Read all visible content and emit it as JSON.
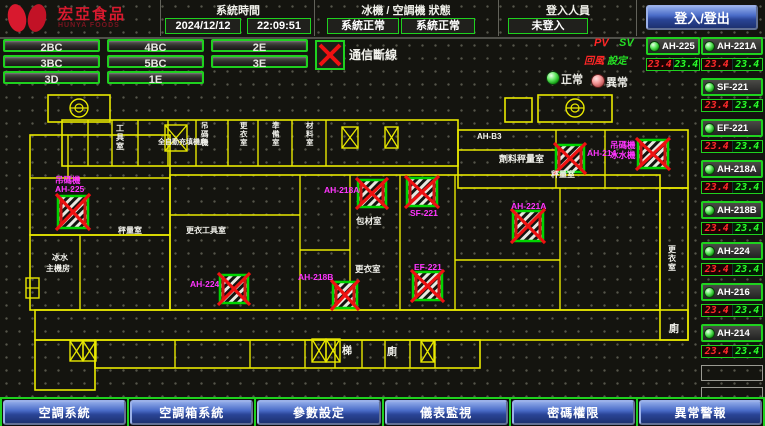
{
  "header": {
    "brand": "宏亞食品",
    "brand_en": "HUNYA FOODS",
    "system_time_label": "系統時間",
    "date": "2024/12/12",
    "time": "22:09:51",
    "status_label": "冰機 / 空調機 狀態",
    "chiller_status": "系統正常",
    "ahu_status": "系統正常",
    "login_label": "登入人員",
    "login_status": "未登入",
    "login_button": "登入/登出"
  },
  "floor_buttons": [
    "2BC",
    "4BC",
    "2E",
    "3BC",
    "5BC",
    "3E",
    "3D",
    "1E"
  ],
  "legend": {
    "comm_fail_label": "通信斷線",
    "normal_label": "正常",
    "abnormal_label": "異常",
    "pv": "PV",
    "sv": "SV",
    "pv_sub": "回風",
    "sv_sub": "設定"
  },
  "ahu_panel": {
    "left_column": [
      {
        "name": "AH-225",
        "pv": "23.4",
        "sv": "23.4"
      }
    ],
    "right_column": [
      {
        "name": "AH-221A",
        "pv": "23.4",
        "sv": "23.4"
      },
      {
        "name": "SF-221",
        "pv": "23.4",
        "sv": "23.4"
      },
      {
        "name": "EF-221",
        "pv": "23.4",
        "sv": "23.4"
      },
      {
        "name": "AH-218A",
        "pv": "23.4",
        "sv": "23.4"
      },
      {
        "name": "AH-218B",
        "pv": "23.4",
        "sv": "23.4"
      },
      {
        "name": "AH-224",
        "pv": "23.4",
        "sv": "23.4"
      },
      {
        "name": "AH-216",
        "pv": "23.4",
        "sv": "23.4"
      },
      {
        "name": "AH-214",
        "pv": "23.4",
        "sv": "23.4"
      }
    ],
    "empty_slots": 2
  },
  "bottom_nav": [
    "空調系統",
    "空調箱系統",
    "參數設定",
    "儀表監視",
    "密碼權限",
    "異常警報"
  ],
  "colors": {
    "wall": "#e8e800",
    "device_border": "#00d400",
    "cross": "#ee1111",
    "magenta": "#ff35ff",
    "white": "#f2f2ec"
  },
  "plan": {
    "rects": [
      [
        62,
        120,
        396,
        46
      ],
      [
        458,
        130,
        230,
        58
      ],
      [
        48,
        95,
        62,
        27
      ],
      [
        538,
        95,
        74,
        27
      ],
      [
        505,
        98,
        27,
        24
      ],
      [
        30,
        135,
        140,
        100
      ],
      [
        30,
        235,
        140,
        75
      ],
      [
        170,
        175,
        490,
        135
      ],
      [
        35,
        310,
        653,
        30
      ],
      [
        95,
        340,
        385,
        28
      ],
      [
        35,
        340,
        60,
        50
      ],
      [
        660,
        188,
        28,
        152
      ]
    ],
    "lines": [
      [
        88,
        120,
        88,
        166
      ],
      [
        112,
        120,
        112,
        166
      ],
      [
        138,
        120,
        138,
        166
      ],
      [
        168,
        120,
        168,
        166
      ],
      [
        196,
        120,
        196,
        166
      ],
      [
        228,
        120,
        228,
        166
      ],
      [
        258,
        120,
        258,
        166
      ],
      [
        292,
        120,
        292,
        166
      ],
      [
        326,
        120,
        326,
        166
      ],
      [
        458,
        150,
        556,
        150
      ],
      [
        556,
        130,
        556,
        188
      ],
      [
        605,
        130,
        605,
        188
      ],
      [
        30,
        178,
        170,
        178
      ],
      [
        68,
        135,
        68,
        178
      ],
      [
        80,
        235,
        80,
        310
      ],
      [
        300,
        175,
        300,
        310
      ],
      [
        350,
        175,
        350,
        310
      ],
      [
        400,
        175,
        400,
        310
      ],
      [
        455,
        175,
        455,
        310
      ],
      [
        560,
        188,
        560,
        310
      ],
      [
        170,
        215,
        300,
        215
      ],
      [
        300,
        250,
        350,
        250
      ],
      [
        455,
        260,
        560,
        260
      ],
      [
        175,
        340,
        175,
        368
      ],
      [
        250,
        340,
        250,
        368
      ],
      [
        305,
        340,
        305,
        368
      ],
      [
        335,
        340,
        335,
        368
      ],
      [
        362,
        340,
        362,
        368
      ],
      [
        385,
        340,
        385,
        368
      ],
      [
        410,
        340,
        410,
        368
      ],
      [
        435,
        340,
        435,
        368
      ]
    ],
    "xboxes": [
      [
        165,
        125,
        22,
        26
      ],
      [
        342,
        127,
        16,
        21
      ],
      [
        385,
        127,
        13,
        21
      ],
      [
        70,
        341,
        13,
        20
      ],
      [
        83,
        341,
        13,
        20
      ],
      [
        312,
        339,
        14,
        23
      ],
      [
        326,
        339,
        14,
        23
      ],
      [
        421,
        341,
        13,
        21
      ]
    ],
    "stairs": [
      [
        79,
        108
      ],
      [
        575,
        108
      ]
    ],
    "mini": [
      26,
      278,
      13,
      20
    ],
    "devices": [
      {
        "id": "AH-225",
        "x": 58,
        "y": 196,
        "w": 30,
        "h": 32
      },
      {
        "id": "AH-224",
        "x": 220,
        "y": 275,
        "w": 28,
        "h": 28
      },
      {
        "id": "AH-218A",
        "x": 358,
        "y": 180,
        "w": 28,
        "h": 27
      },
      {
        "id": "SF-221",
        "x": 407,
        "y": 178,
        "w": 30,
        "h": 28
      },
      {
        "id": "EF-221",
        "x": 413,
        "y": 272,
        "w": 29,
        "h": 28
      },
      {
        "id": "AH-218B",
        "x": 333,
        "y": 282,
        "w": 24,
        "h": 26
      },
      {
        "id": "AH-221A",
        "x": 513,
        "y": 211,
        "w": 30,
        "h": 30
      },
      {
        "id": "AH-214",
        "x": 556,
        "y": 145,
        "w": 28,
        "h": 27
      },
      {
        "id": "冰水機",
        "x": 638,
        "y": 140,
        "w": 30,
        "h": 28
      }
    ],
    "labels_magenta": [
      {
        "text": "吊碼機",
        "x": 55,
        "y": 183
      },
      {
        "text": "AH-225",
        "x": 55,
        "y": 192
      },
      {
        "text": "AH-224",
        "x": 190,
        "y": 287
      },
      {
        "text": "AH-218A",
        "x": 324,
        "y": 193
      },
      {
        "text": "SF-221",
        "x": 410,
        "y": 216
      },
      {
        "text": "EF-221",
        "x": 414,
        "y": 270
      },
      {
        "text": "AH-218B",
        "x": 298,
        "y": 280
      },
      {
        "text": "AH-221A",
        "x": 511,
        "y": 209
      },
      {
        "text": "AH-214",
        "x": 587,
        "y": 156
      },
      {
        "text": "吊碼機",
        "x": 610,
        "y": 148
      },
      {
        "text": "冰水機",
        "x": 610,
        "y": 158
      }
    ],
    "labels_white": [
      {
        "text": "工具室",
        "x": 116,
        "y": 131,
        "vert": true,
        "size": 8
      },
      {
        "text": "全自動充填機房",
        "x": 158,
        "y": 144,
        "vert": false,
        "size": 7
      },
      {
        "text": "吊碼機",
        "x": 201,
        "y": 128,
        "vert": true,
        "size": 7.5
      },
      {
        "text": "更衣室",
        "x": 240,
        "y": 128,
        "vert": true,
        "size": 7.5
      },
      {
        "text": "準備室",
        "x": 272,
        "y": 128,
        "vert": true,
        "size": 7.5
      },
      {
        "text": "材料室",
        "x": 306,
        "y": 128,
        "vert": true,
        "size": 7.5
      },
      {
        "text": "AH-B3",
        "x": 477,
        "y": 139,
        "vert": false,
        "size": 8
      },
      {
        "text": "劑料秤量室",
        "x": 499,
        "y": 162,
        "vert": false,
        "size": 9
      },
      {
        "text": "秤量室",
        "x": 551,
        "y": 177,
        "vert": false,
        "size": 8
      },
      {
        "text": "包材室",
        "x": 356,
        "y": 224,
        "vert": false,
        "size": 8.5
      },
      {
        "text": "更衣室",
        "x": 355,
        "y": 272,
        "vert": false,
        "size": 8.5
      },
      {
        "text": "冰水",
        "x": 52,
        "y": 260,
        "vert": false,
        "size": 8
      },
      {
        "text": "主機房",
        "x": 46,
        "y": 271,
        "vert": false,
        "size": 8
      },
      {
        "text": "秤量室",
        "x": 118,
        "y": 233,
        "vert": false,
        "size": 8
      },
      {
        "text": "更衣工具室",
        "x": 186,
        "y": 233,
        "vert": false,
        "size": 8
      },
      {
        "text": "梯",
        "x": 342,
        "y": 354,
        "vert": false,
        "size": 10
      },
      {
        "text": "廁",
        "x": 387,
        "y": 355,
        "vert": false,
        "size": 10
      },
      {
        "text": "更衣室",
        "x": 668,
        "y": 252,
        "vert": true,
        "size": 8
      },
      {
        "text": "廁",
        "x": 669,
        "y": 332,
        "vert": false,
        "size": 10
      }
    ]
  }
}
